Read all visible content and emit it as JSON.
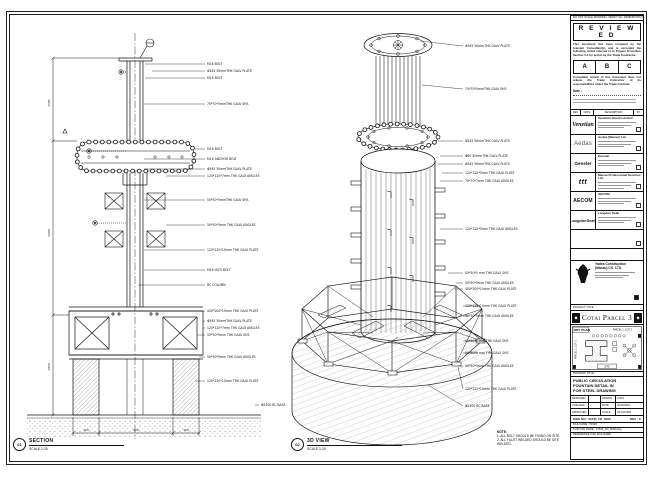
{
  "sheet": {
    "edge_note": "DO NOT SCALE DRAWING. VERIFY ALL DIMENSIONS ON SITE."
  },
  "section_view": {
    "tag": "01",
    "title": "SECTION",
    "scale": "SCALE 1:25",
    "dim_labels": [
      "1585",
      "3200",
      "1650"
    ],
    "bottom_dims": [
      "300",
      "600",
      "300"
    ],
    "callouts": [
      "M16 BOLT",
      "Φ345 50mmTHK GALV PLATE",
      "M16 BOLT",
      "70*70*5mmTHK GALV SHS",
      "M16 BOLT",
      "M16 ANCHOR BOLT",
      "Φ345 50mmTHK GALV PLATE",
      "120*120*7mm THK GALV ANGLES",
      "50*50*5mmTHK GALV SHS",
      "50*50*5mm THK GALV ANGLES",
      "120*120*10mm THK GALV PLATE",
      "M16 HILTI BOLT",
      "RC COLUMN",
      "400*200*10mm THK GALV PLATE",
      "Φ345 50mmTHK GALV PLATE",
      "120*120*7mm THK GALV ANGLES",
      "50*50*5mm THK GALV SHS",
      "50*50*5mm THK GALV ANGLES",
      "120*120*10mm THK GALV PLATE",
      "Φ2300 RC BASE"
    ]
  },
  "iso_view": {
    "tag": "02",
    "title": "3D VIEW",
    "scale": "SCALE 1:25",
    "callouts": [
      "Φ345 50mmTHK GALV PLATE",
      "70*70*5mmTHK GALV SHS",
      "Φ345 50mmTHK GALV PLATE",
      "Φ80 50mmTHK GALV PLATE",
      "Φ345 50mmTHK GALV PLATE",
      "120*120*5mm THK GALV PLATE",
      "70*70*7mm THK GALV ANGLES",
      "120*120*5mm THK GALV ANGLES",
      "50*50*5 mm THK GALV SHS",
      "50*50*5mm THK GALV ANGLES",
      "400*200*10mm THK GALV PLATE",
      "120*120*10mm THK GALV PLATE",
      "50*50*5mm THK GALV ANGLES",
      "50*50*5 mm THK GALV SHS",
      "50*50*5 mm THK GALV SHS",
      "50*50*5mm THK GALV ANGLES",
      "120*120*10mm THK GALV PLATE",
      "Φ2300 RC BASE"
    ],
    "note": {
      "title": "NOTE:",
      "lines": [
        "1. ALL BOLT SHOULD BE FIXING ON SITE.",
        "2. ALL FILLET WELDED SHOULD BE SITE WELDED."
      ]
    }
  },
  "title_block": {
    "stamp": {
      "title": "R E V I E W E D",
      "para1": "This document has been reviewed by the relevant Consultant(s) and is accorded the following status referred to in Project Procedure Section 5.4 for action by the Trade Contractor.",
      "options": [
        "A",
        "B",
        "C"
      ],
      "para2": "Consultant review of this document does not relieve the Trade Contractor of its responsibilities under the Trade Contract.",
      "date_label": "Date :"
    },
    "revision_header": [
      "REV",
      "DATE",
      "DESCRIPTION",
      "BY"
    ],
    "consultants": [
      {
        "logo": "Venetian",
        "name": "Venetian Orient Limited"
      },
      {
        "logo": "Aedas",
        "name": "Aedas (Macau) Ltd."
      },
      {
        "logo": "Gensler",
        "name": "Gensler"
      },
      {
        "logo": "ttt",
        "name": "Macau Professional Services Ltd."
      },
      {
        "logo": "AECOM",
        "name": "AECOM"
      },
      {
        "logo": "LangdonSeah",
        "name": "Langdon Seah"
      }
    ],
    "contractor": {
      "name_line1": "Yadea Construction",
      "name_line2": "(Macau) CO. LTD."
    },
    "project_label": "PROJECT TITLE",
    "project_title": "Cotai Parcel 3",
    "ornament_glyph": "◆",
    "key_plan": {
      "label": "KEY PLAN",
      "parcel_right": "PARCEL 1, LOT 2",
      "parcel_left": "PARCEL 1, LOT 1",
      "site": "SITE"
    },
    "drawing_title": {
      "label": "DRAWING TITLE:",
      "line1": "PUBLIC CIRCULATION",
      "line2": "FOUNTAIN DETAIL IN",
      "line3": "FOR STEEL DRAWING"
    },
    "info_table": {
      "rows": [
        [
          "DESIGNED",
          "-",
          "DRAWN",
          "LOKO"
        ],
        [
          "CHECKED",
          "-",
          "DATE",
          "04/12/2015"
        ],
        [
          "APPROVED",
          "-",
          "SCALE",
          "AS SHOWN"
        ]
      ]
    },
    "dwg_no": "DWG NO : 51545_FD_5000",
    "rev": "REV : C",
    "file_rows": [
      "FILE NAME : 51545",
      "CAD FILE NAME : 51545_FD_5000.dwg",
      "REFERENCE CAD FILE NAME :"
    ]
  }
}
